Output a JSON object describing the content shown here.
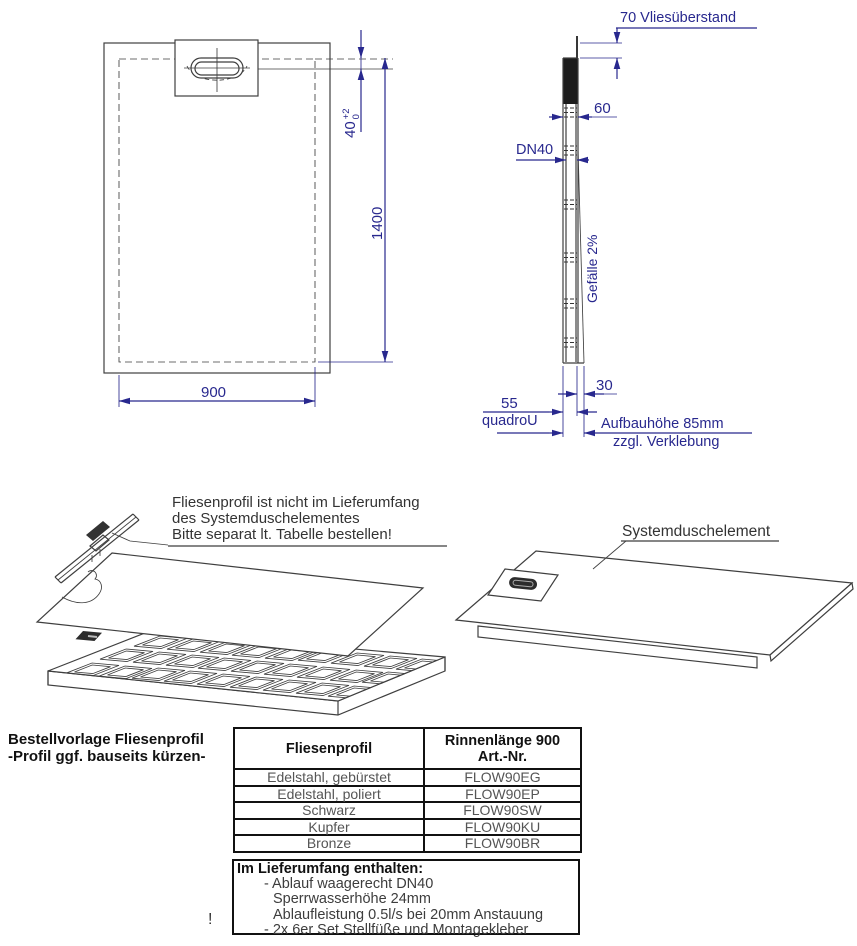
{
  "colors": {
    "dimension_blue": "#28288e",
    "drawing_gray": "#3f3f3f",
    "text_dark": "#333333"
  },
  "plan_view": {
    "dim_length": "1400",
    "dim_width": "900",
    "dim_drain_offset": "40",
    "tolerance_plus": "+2",
    "tolerance_zero": "0"
  },
  "side_view": {
    "fleece_label": "70 Vliesüberstand",
    "dim_top_width": "60",
    "drain_pipe": "DN40",
    "slope_label": "Gefälle 2%",
    "dim_30": "30",
    "dim_55": "55",
    "product_name": "quadroU",
    "build_height": "Aufbauhöhe 85mm",
    "glue_note": "zzgl. Verklebung"
  },
  "exploded": {
    "note_line1": "Fliesenprofil ist nicht im Lieferumfang",
    "note_line2": "des Systemduschelementes",
    "note_line3": "Bitte separat lt. Tabelle bestellen!",
    "element_label": "Systemduschelement"
  },
  "order_note": {
    "line1": "Bestellvorlage Fliesenprofil",
    "line2": "-Profil ggf. bauseits kürzen-"
  },
  "table": {
    "header_col1": "Fliesenprofil",
    "header_col2_line1": "Rinnenlänge 900",
    "header_col2_line2": "Art.-Nr.",
    "rows": [
      {
        "profile": "Edelstahl, gebürstet",
        "art_nr": "FLOW90EG"
      },
      {
        "profile": "Edelstahl, poliert",
        "art_nr": "FLOW90EP"
      },
      {
        "profile": "Schwarz",
        "art_nr": "FLOW90SW"
      },
      {
        "profile": "Kupfer",
        "art_nr": "FLOW90KU"
      },
      {
        "profile": "Bronze",
        "art_nr": "FLOW90BR"
      }
    ]
  },
  "included": {
    "title": "Im Lieferumfang enthalten:",
    "items": [
      "- Ablauf waagerecht DN40",
      "Sperrwasserhöhe 24mm",
      "Ablaufleistung 0.5l/s bei 20mm Anstauung",
      "- 2x 6er Set Stellfüße und Montagekleber"
    ],
    "mark": "!"
  }
}
